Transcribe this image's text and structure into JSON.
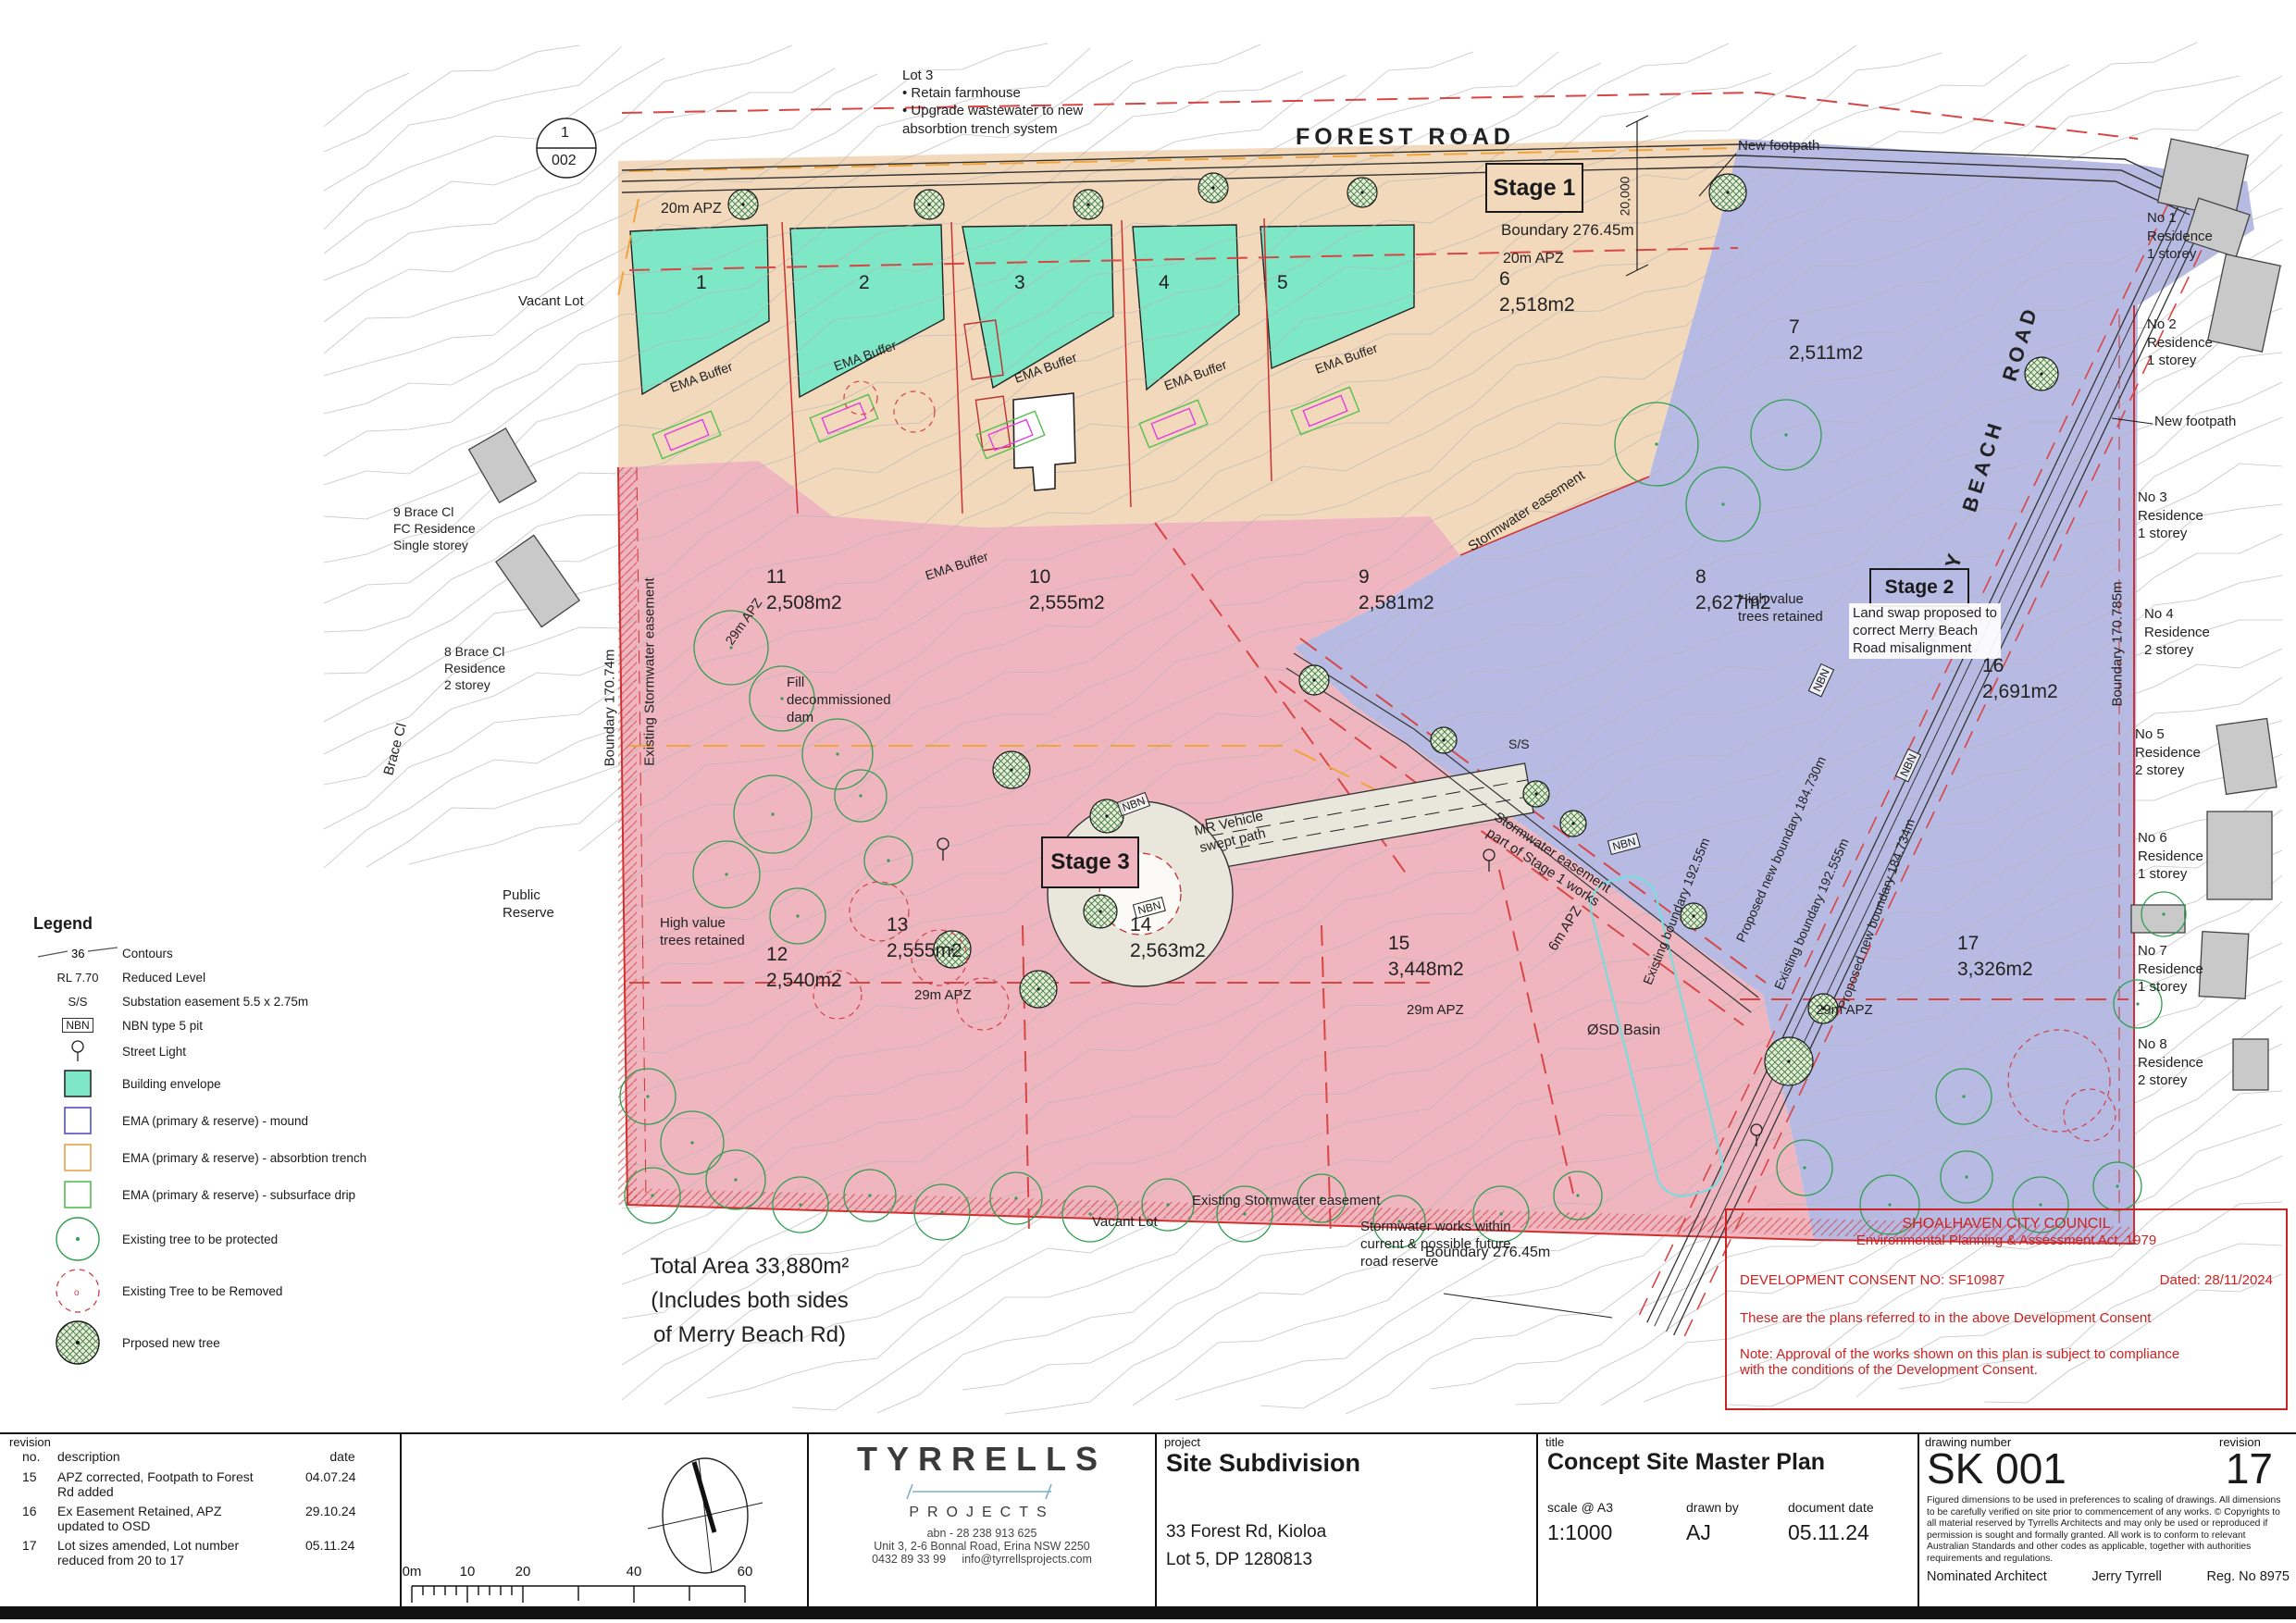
{
  "colors": {
    "stage1_orange": "#f3d9bc",
    "stage2_blue": "#b7bbe3",
    "stage3_pink": "#f0b6c0",
    "envelope_teal": "#7de7c6",
    "boundary_red": "#d03030",
    "council_red": "#cc2222",
    "tree_green": "#2e9e4f",
    "osd_cyan": "#7adcdc",
    "easement_orange": "#f0a43c",
    "contour_grey": "#b5b5b5"
  },
  "plan": {
    "detail_marker": {
      "top": "1",
      "bottom": "002"
    },
    "lot3_note": "Lot 3\n• Retain farmhouse\n• Upgrade wastewater to new\n   absorbtion trench system",
    "forest_road": "FOREST    ROAD",
    "merry_beach_road": "MERRY    BEACH    ROAD",
    "stage1": "Stage 1",
    "stage2": "Stage 2",
    "stage3": "Stage 3",
    "boundary_top": "Boundary 276.45m",
    "boundary_bottom": "Boundary 276.45m",
    "apz20_a": "20m APZ",
    "apz20_b": "20m APZ",
    "apz29": "29m APZ",
    "apz6": "6m APZ",
    "dim_20000": "20,000",
    "new_footpath_top": "New footpath",
    "new_footpath_right": "New footpath",
    "vacant_lot_top": "Vacant Lot",
    "vacant_lot_bottom": "Vacant Lot",
    "brace9": "9 Brace Cl\nFC Residence\nSingle storey",
    "brace8": "8 Brace Cl\nResidence\n2 storey",
    "brace_cl": "Brace  Cl",
    "public_reserve": "Public\nReserve",
    "ema_buffer": "EMA Buffer",
    "stormwater_easement": "Stormwater easement",
    "high_value": "High value\ntrees retained",
    "fill_dam": "Fill\ndecommissioned\ndam",
    "mr_vehicle": "MR Vehicle\nswept path",
    "stormwater_stage1": "Stormwater easement\npart of Stage 1 works",
    "ss": "S/S",
    "nbn": "NBN",
    "land_swap": "Land swap proposed to\ncorrect Merry Beach\nRoad misalignment",
    "osd_basin": "ØSD Basin",
    "existing_sw_v": "Existing Stormwater easement",
    "existing_sw_h": "Existing Stormwater easement",
    "boundary_170_74": "Boundary 170.74m",
    "boundary_170_785": "Boundary 170.785m",
    "existing_b_192_55": "Existing boundary 192.55m",
    "proposed_b_184_730": "Proposed new boundary 184.730m",
    "existing_b_192_555": "Existing boundary 192.555m",
    "proposed_b_184_734": "Proposed new boundary 184.734m",
    "stormwater_works": "Stormwater works within\ncurrent & possible future\nroad reserve",
    "total_area": "Total Area 33,880m²\n(Includes both sides\nof Merry Beach Rd)",
    "lots": [
      {
        "n": "1",
        "a": ""
      },
      {
        "n": "2",
        "a": ""
      },
      {
        "n": "3",
        "a": ""
      },
      {
        "n": "4",
        "a": ""
      },
      {
        "n": "5",
        "a": ""
      },
      {
        "n": "6",
        "a": "2,518m2"
      },
      {
        "n": "7",
        "a": "2,511m2"
      },
      {
        "n": "8",
        "a": "2,627m2"
      },
      {
        "n": "9",
        "a": "2,581m2"
      },
      {
        "n": "10",
        "a": "2,555m2"
      },
      {
        "n": "11",
        "a": "2,508m2"
      },
      {
        "n": "12",
        "a": "2,540m2"
      },
      {
        "n": "13",
        "a": "2,555m2"
      },
      {
        "n": "14",
        "a": "2,563m2"
      },
      {
        "n": "15",
        "a": "3,448m2"
      },
      {
        "n": "16",
        "a": "2,691m2"
      },
      {
        "n": "17",
        "a": "3,326m2"
      }
    ],
    "residences": [
      "No 1\nResidence\n1 storey",
      "No 2\nResidence\n1 storey",
      "No 3\nResidence\n1 storey",
      "No 4\nResidence\n2 storey",
      "No 5\nResidence\n2 storey",
      "No 6\nResidence\n1 storey",
      "No 7\nResidence\n1 storey",
      "No 8\nResidence\n2 storey"
    ]
  },
  "legend": {
    "title": "Legend",
    "items": [
      {
        "sym": "contour",
        "sym_text": "36",
        "label": "Contours"
      },
      {
        "sym": "text",
        "sym_text": "RL 7.70",
        "label": "Reduced Level"
      },
      {
        "sym": "text",
        "sym_text": "S/S",
        "label": "Substation easement 5.5 x 2.75m"
      },
      {
        "sym": "nbnbox",
        "sym_text": "NBN",
        "label": "NBN type 5 pit"
      },
      {
        "sym": "light",
        "sym_text": "",
        "label": "Street Light"
      },
      {
        "sym": "box",
        "fill": "#7de7c6",
        "stroke": "#2a2a2a",
        "label": "Building envelope"
      },
      {
        "sym": "box",
        "fill": "none",
        "stroke": "#5050c0",
        "label": "EMA (primary & reserve) - mound"
      },
      {
        "sym": "box",
        "fill": "none",
        "stroke": "#e8a24a",
        "label": "EMA (primary & reserve) - absorbtion trench"
      },
      {
        "sym": "box",
        "fill": "none",
        "stroke": "#55c050",
        "label": "EMA (primary & reserve) - subsurface drip"
      },
      {
        "sym": "tree0",
        "sym_text": "",
        "label": "Existing tree to be protected"
      },
      {
        "sym": "tree1",
        "sym_text": "",
        "label": "Existing Tree to be Removed"
      },
      {
        "sym": "tree2",
        "sym_text": "",
        "label": "Prposed new tree"
      }
    ]
  },
  "council": {
    "l1": "SHOALHAVEN CITY COUNCIL",
    "l2": "Environmental Planning & Assessment Act, 1979",
    "consent": "DEVELOPMENT CONSENT NO: SF10987",
    "dated": "Dated: 28/11/2024",
    "referred": "These are the plans referred to in the above Development Consent",
    "note": "Note:  Approval of the works shown on this plan is subject to compliance\nwith the conditions of the Development Consent."
  },
  "titleblock": {
    "labels": {
      "revision": "revision",
      "no": "no.",
      "description": "description",
      "date": "date",
      "project": "project",
      "title": "title",
      "drawing_number": "drawing number",
      "revision_right": "revision"
    },
    "revisions": [
      {
        "no": "15",
        "description": "APZ corrected, Footpath to Forest\nRd added",
        "date": "04.07.24"
      },
      {
        "no": "16",
        "description": "Ex Easement Retained, APZ\nupdated to OSD",
        "date": "29.10.24"
      },
      {
        "no": "17",
        "description": "Lot sizes amended, Lot number\nreduced from 20 to 17",
        "date": "05.11.24"
      }
    ],
    "scalebar": [
      "0m",
      "10",
      "20",
      "40",
      "60"
    ],
    "firm": {
      "name": "TYRRELLS",
      "sub": "PROJECTS",
      "abn": "abn - 28 238 913 625",
      "address": "Unit  3,  2-6  Bonnal  Road,  Erina  NSW  2250",
      "phone": "0432 89 33 99",
      "email": "info@tyrrellsprojects.com"
    },
    "project": {
      "name": "Site Subdivision",
      "address1": "33 Forest Rd, Kioloa",
      "address2": "Lot 5, DP 1280813"
    },
    "title": {
      "name": "Concept Site Master Plan",
      "scale_label": "scale @ A3",
      "scale": "1:1000",
      "drawn_label": "drawn by",
      "drawn": "AJ",
      "docdate_label": "document date",
      "docdate": "05.11.24"
    },
    "number": {
      "value": "SK 001",
      "rev": "17",
      "disclaimer": "Figured dimensions to be used in preferences to scaling of drawings. All dimensions to be carefully verified on site prior to commencement of any works. © Copyrights to all material reserved by Tyrrells Architects and may only be used or reproduced if permission is sought and formally granted. All work is to conform to relevant Australian Standards and other codes as applicable, together with authorities requirements and regulations.",
      "nominated": "Nominated Architect",
      "architect": "Jerry Tyrrell",
      "reg": "Reg. No 8975"
    }
  }
}
